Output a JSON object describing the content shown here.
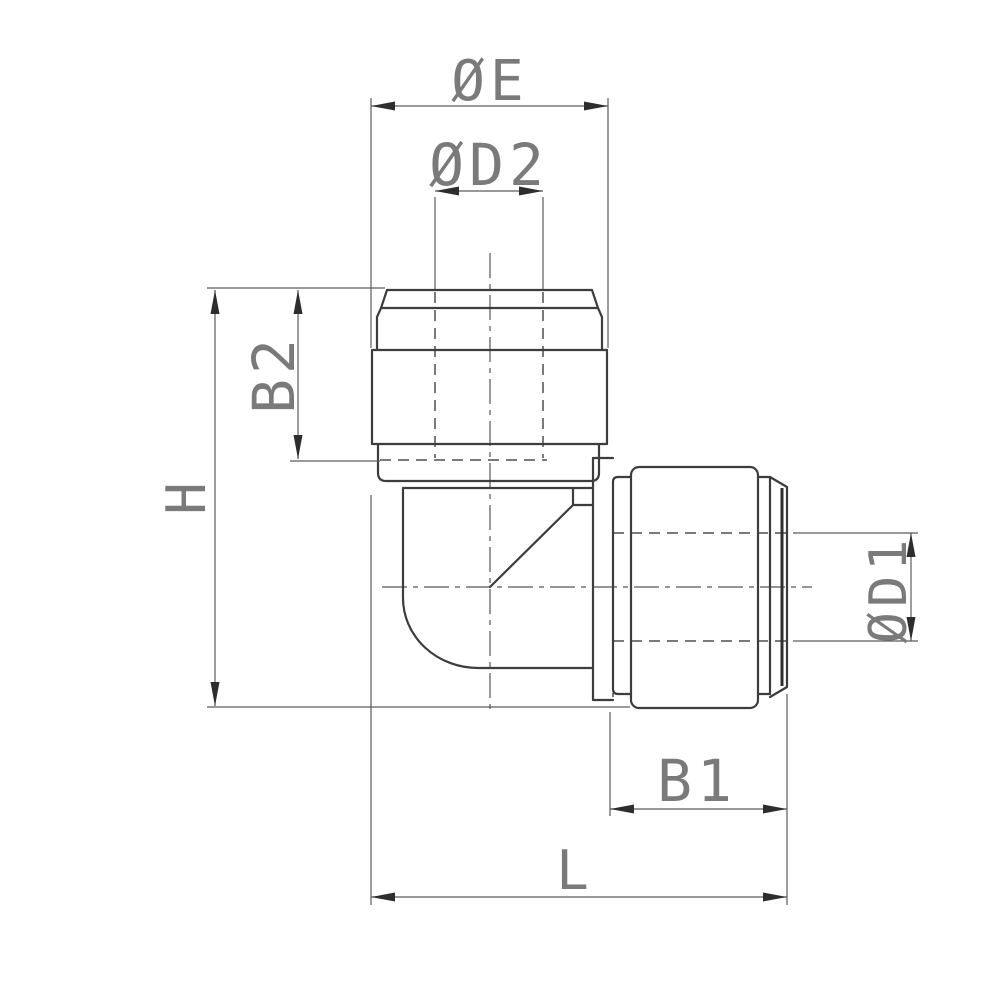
{
  "drawing": {
    "kind": "dimensioned technical drawing of a 90-degree elbow push-in tube fitting, side elevation",
    "labels": {
      "oe": "ØE",
      "od2": "ØD2",
      "b2": "B2",
      "h": "H",
      "od1": "ØD1",
      "b1": "B1",
      "l": "L"
    },
    "colors": {
      "background": "#ffffff",
      "part_outline": "#3d3d3d",
      "dimension_lines": "#5c5c5c",
      "hidden_lines": "#4f4f4f",
      "label_text": "#7a7a7a",
      "arrowheads": "#2d2d2d"
    }
  }
}
